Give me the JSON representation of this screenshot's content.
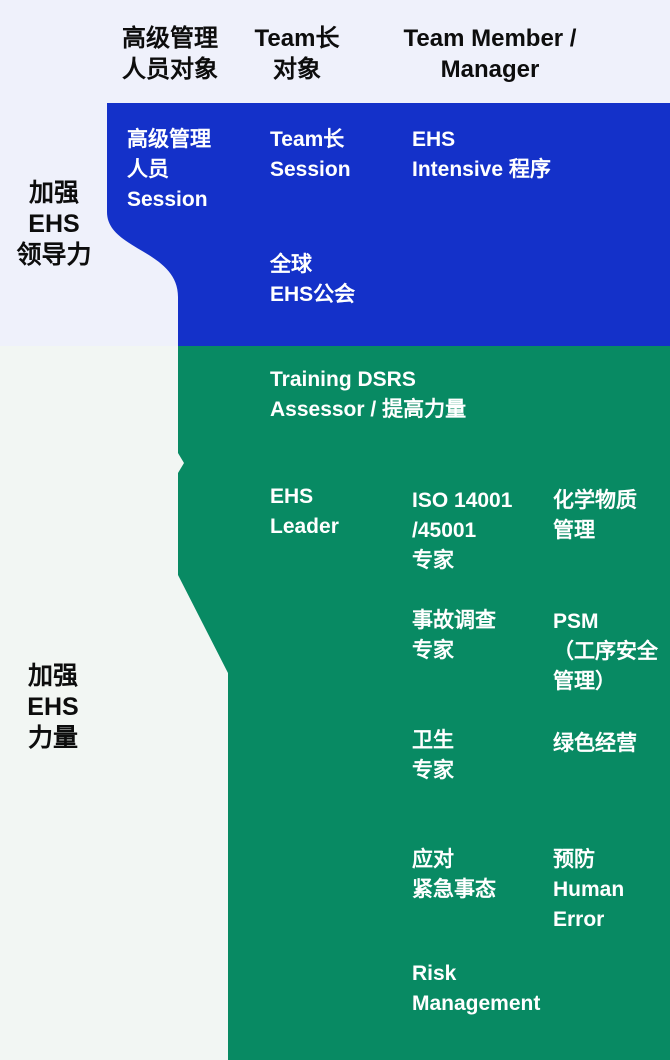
{
  "palette": {
    "leadership_blue": "#1431c9",
    "strength_green": "#088a63",
    "background_top": "#eff1fb",
    "background_bottom": "#f2f6f3",
    "text_dark": "#0d0d0d",
    "text_light": "#ffffff"
  },
  "header": {
    "col_senior": "高级管理\n人员对象",
    "col_team_lead": "Team长\n对象",
    "col_member": "Team Member /\nManager"
  },
  "groups": {
    "leadership": {
      "side_label": "加强\nEHS\n领导力",
      "cells": {
        "senior_session": "高级管理\n人员\nSession",
        "team_lead_session": "Team长\nSession",
        "ehs_intensive": "EHS\nIntensive 程序",
        "global_ehs": "全球\nEHS公会"
      }
    },
    "strength": {
      "side_label": "加强\nEHS\n力量",
      "cells": {
        "training_dsrs": "Training DSRS\nAssessor / 提高力量",
        "ehs_leader": "EHS\nLeader",
        "iso_expert": "ISO 14001\n/45001\n专家",
        "chemical_mgmt": "化学物质\n管理",
        "incident_expert": "事故调查\n专家",
        "psm": "PSM\n（工序安全\n管理）",
        "hygiene_expert": "卫生\n专家",
        "green_mgmt": "绿色经营",
        "emergency": "应对\n紧急事态",
        "human_error": "预防\nHuman\nError",
        "risk_mgmt": "Risk\nManagement"
      }
    }
  }
}
